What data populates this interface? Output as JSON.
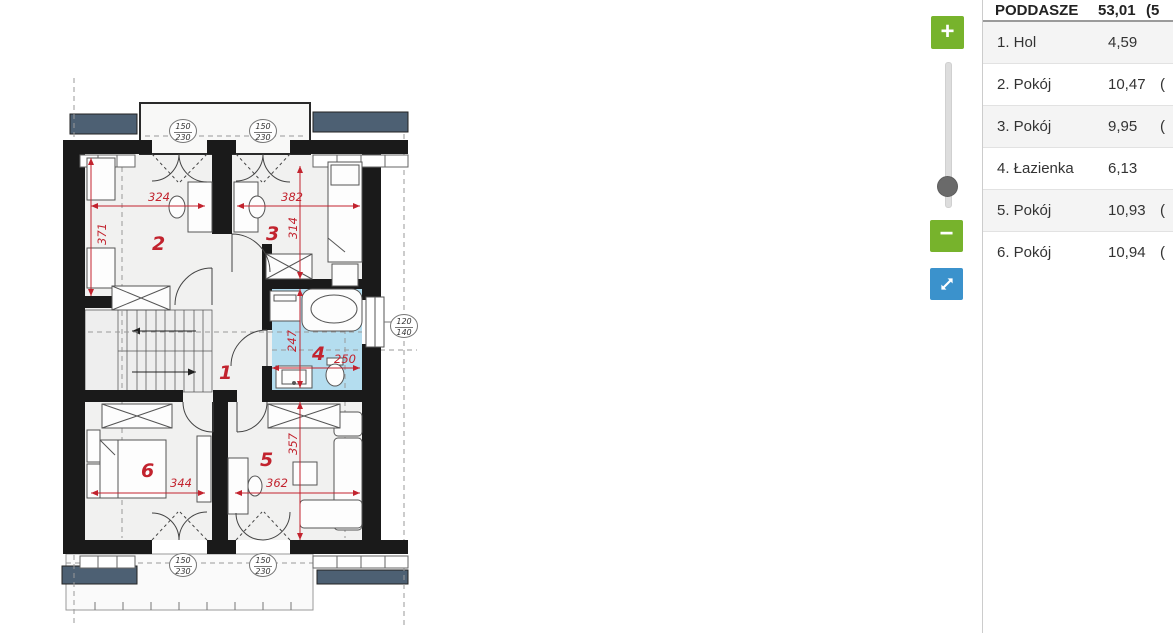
{
  "panel": {
    "header": {
      "name": "PODDASZE",
      "area": "53,01",
      "extra": "(5"
    },
    "rows": [
      {
        "name": "1. Hol",
        "area": "4,59",
        "extra": ""
      },
      {
        "name": "2. Pokój",
        "area": "10,47",
        "extra": "("
      },
      {
        "name": "3. Pokój",
        "area": "9,95",
        "extra": "("
      },
      {
        "name": "4. Łazienka",
        "area": "6,13",
        "extra": ""
      },
      {
        "name": "5. Pokój",
        "area": "10,93",
        "extra": "("
      },
      {
        "name": "6. Pokój",
        "area": "10,94",
        "extra": "("
      }
    ]
  },
  "controls": {
    "zoom_in": "+",
    "zoom_out": "−"
  },
  "plan": {
    "rooms": {
      "r1": "1",
      "r2": "2",
      "r3": "3",
      "r4": "4",
      "r5": "5",
      "r6": "6"
    },
    "dims": {
      "room2_w": "324",
      "room2_h": "371",
      "room3_w": "382",
      "room3_h": "314",
      "room4_h": "247",
      "room4_w": "250",
      "room5_h": "357",
      "room5_w": "362",
      "room6_w": "344"
    },
    "windows": {
      "dormer_w": "150",
      "dormer_h": "230",
      "bath_w": "120",
      "bath_h": "140"
    },
    "colors": {
      "bath": "#b4ddef",
      "roof": "#4d6073",
      "dim": "#c2232e",
      "wall": "#1a1a1a"
    }
  }
}
